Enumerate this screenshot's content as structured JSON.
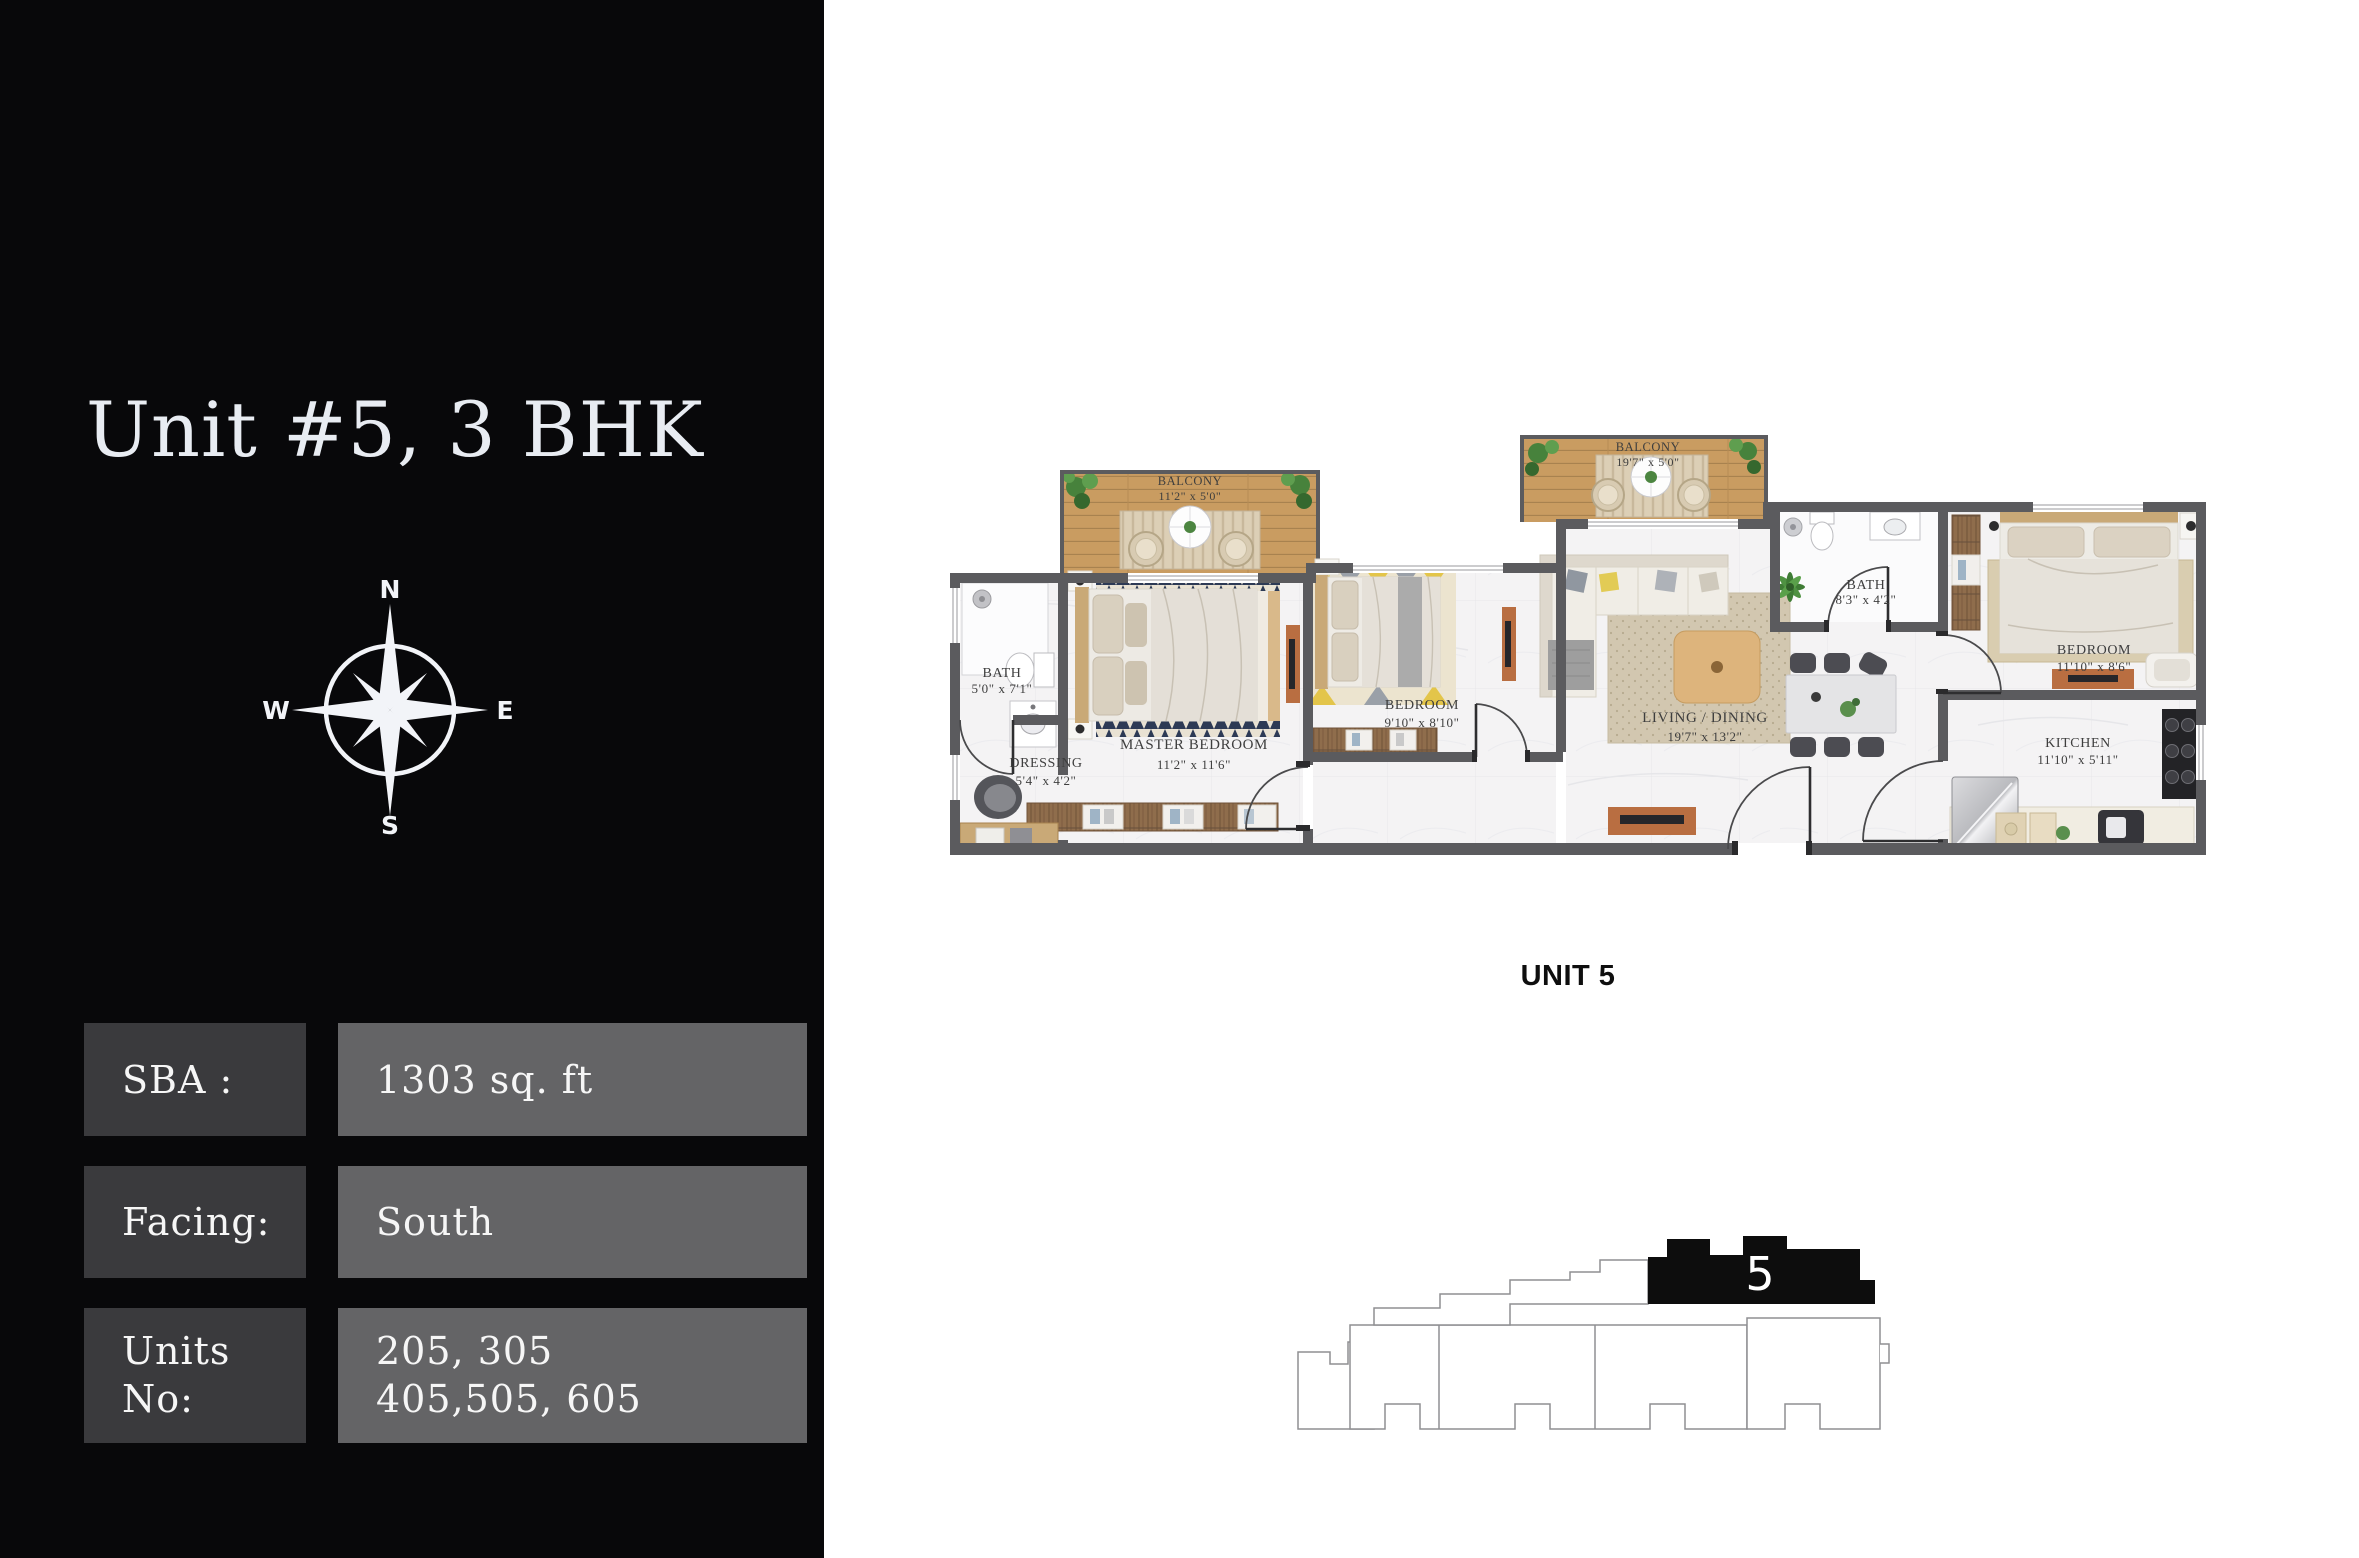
{
  "sidebar": {
    "title": "Unit #5, 3 BHK",
    "compass": {
      "north": "N",
      "east": "E",
      "south": "S",
      "west": "W"
    },
    "info_rows": [
      {
        "label_lines": [
          "SBA :"
        ],
        "value_lines": [
          "1303 sq. ft"
        ]
      },
      {
        "label_lines": [
          "Facing:"
        ],
        "value_lines": [
          "South"
        ]
      },
      {
        "label_lines": [
          "Units",
          "No:"
        ],
        "value_lines": [
          "205, 305",
          "405,505, 605"
        ]
      }
    ]
  },
  "floorplan": {
    "unit_caption": "UNIT 5",
    "rooms": [
      {
        "name": "BALCONY",
        "dims": "11'2\" x 5'0\""
      },
      {
        "name": "BATH",
        "dims": "5'0\" x 7'1\""
      },
      {
        "name": "DRESSING",
        "dims": "5'4\" x 4'2\""
      },
      {
        "name": "MASTER BEDROOM",
        "dims": "11'2\" x 11'6\""
      },
      {
        "name": "BEDROOM",
        "dims": "9'10\" x 8'10\""
      },
      {
        "name": "BALCONY",
        "dims": "19'7\" x 5'0\""
      },
      {
        "name": "LIVING / DINING",
        "dims": "19'7\" x 13'2\""
      },
      {
        "name": "BATH",
        "dims": "8'3\" x 4'2\""
      },
      {
        "name": "BEDROOM",
        "dims": "11'10\" x 8'6\""
      },
      {
        "name": "KITCHEN",
        "dims": "11'10\" x 5'11\""
      }
    ]
  },
  "keyplan": {
    "unit_number": "5"
  },
  "colors": {
    "sidebar_bg": "#08080a",
    "label_box": "#3a3a3d",
    "value_box": "#646466",
    "title_text": "#e8ecf2",
    "wall": "#5b5b5e",
    "balcony_wood": "#c99c61",
    "accent_orange": "#b96e41",
    "keyplan_fill": "#0d0d0d"
  }
}
